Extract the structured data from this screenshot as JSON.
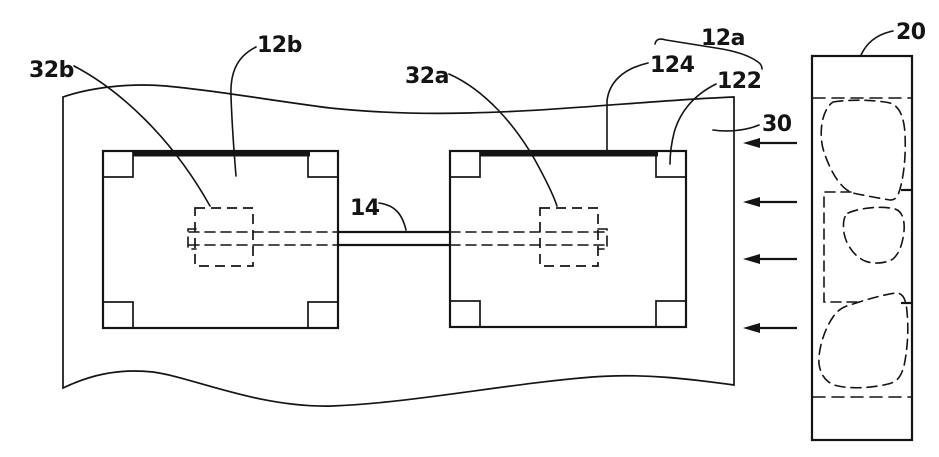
{
  "figure": {
    "background": "#ffffff",
    "ink": "#141414",
    "labels": {
      "pad_left": "32b",
      "die_left": "12b",
      "pad_right": "32a",
      "die_right_group": "12a",
      "die_right_body": "124",
      "die_right_frame": "122",
      "substrate": "30",
      "carrier": "20",
      "bridge": "14"
    },
    "arrows": {
      "count": 4,
      "direction": "left"
    }
  }
}
